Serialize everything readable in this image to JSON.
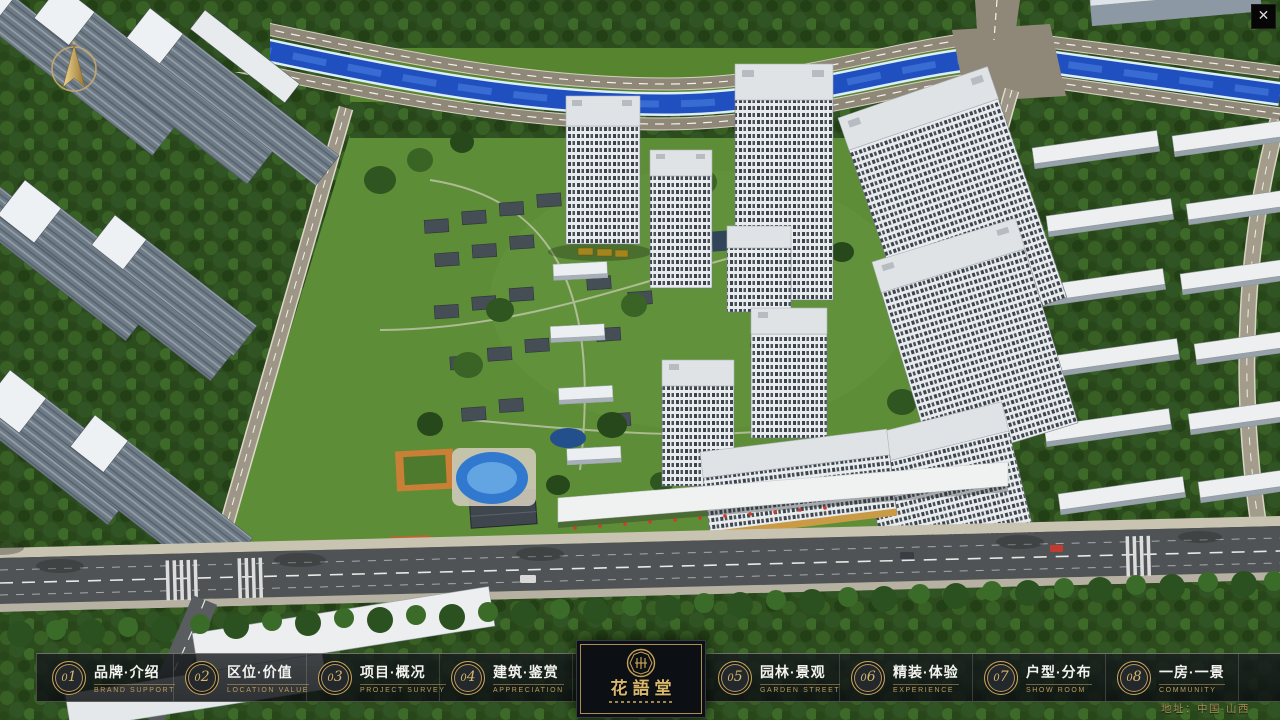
{
  "icons": {
    "close": "✕"
  },
  "menu": {
    "items": [
      {
        "number": "01",
        "label_zh": "品牌·介绍",
        "label_en": "BRAND SUPPORT"
      },
      {
        "number": "02",
        "label_zh": "区位·价值",
        "label_en": "LOCATION VALUE"
      },
      {
        "number": "03",
        "label_zh": "项目·概况",
        "label_en": "PROJECT SURVEY"
      },
      {
        "number": "04",
        "label_zh": "建筑·鉴赏",
        "label_en": "APPRECIATION"
      },
      {
        "number": "05",
        "label_zh": "园林·景观",
        "label_en": "GARDEN STREET"
      },
      {
        "number": "06",
        "label_zh": "精装·体验",
        "label_en": "EXPERIENCE"
      },
      {
        "number": "07",
        "label_zh": "户型·分布",
        "label_en": "SHOW ROOM"
      },
      {
        "number": "08",
        "label_zh": "一房·一景",
        "label_en": "COMMUNITY"
      }
    ]
  },
  "logo": {
    "title": "花語堂"
  },
  "footer": {
    "address": "地址：中国·山西"
  },
  "colors": {
    "gold_accent": "#c9a55a",
    "menu_bar_bg": "rgba(16,20,24,0.8)",
    "river_blue": "#2050c0",
    "grass_green": "#57852f",
    "road_asphalt": "#4f5356",
    "building_white": "#edeff1"
  }
}
